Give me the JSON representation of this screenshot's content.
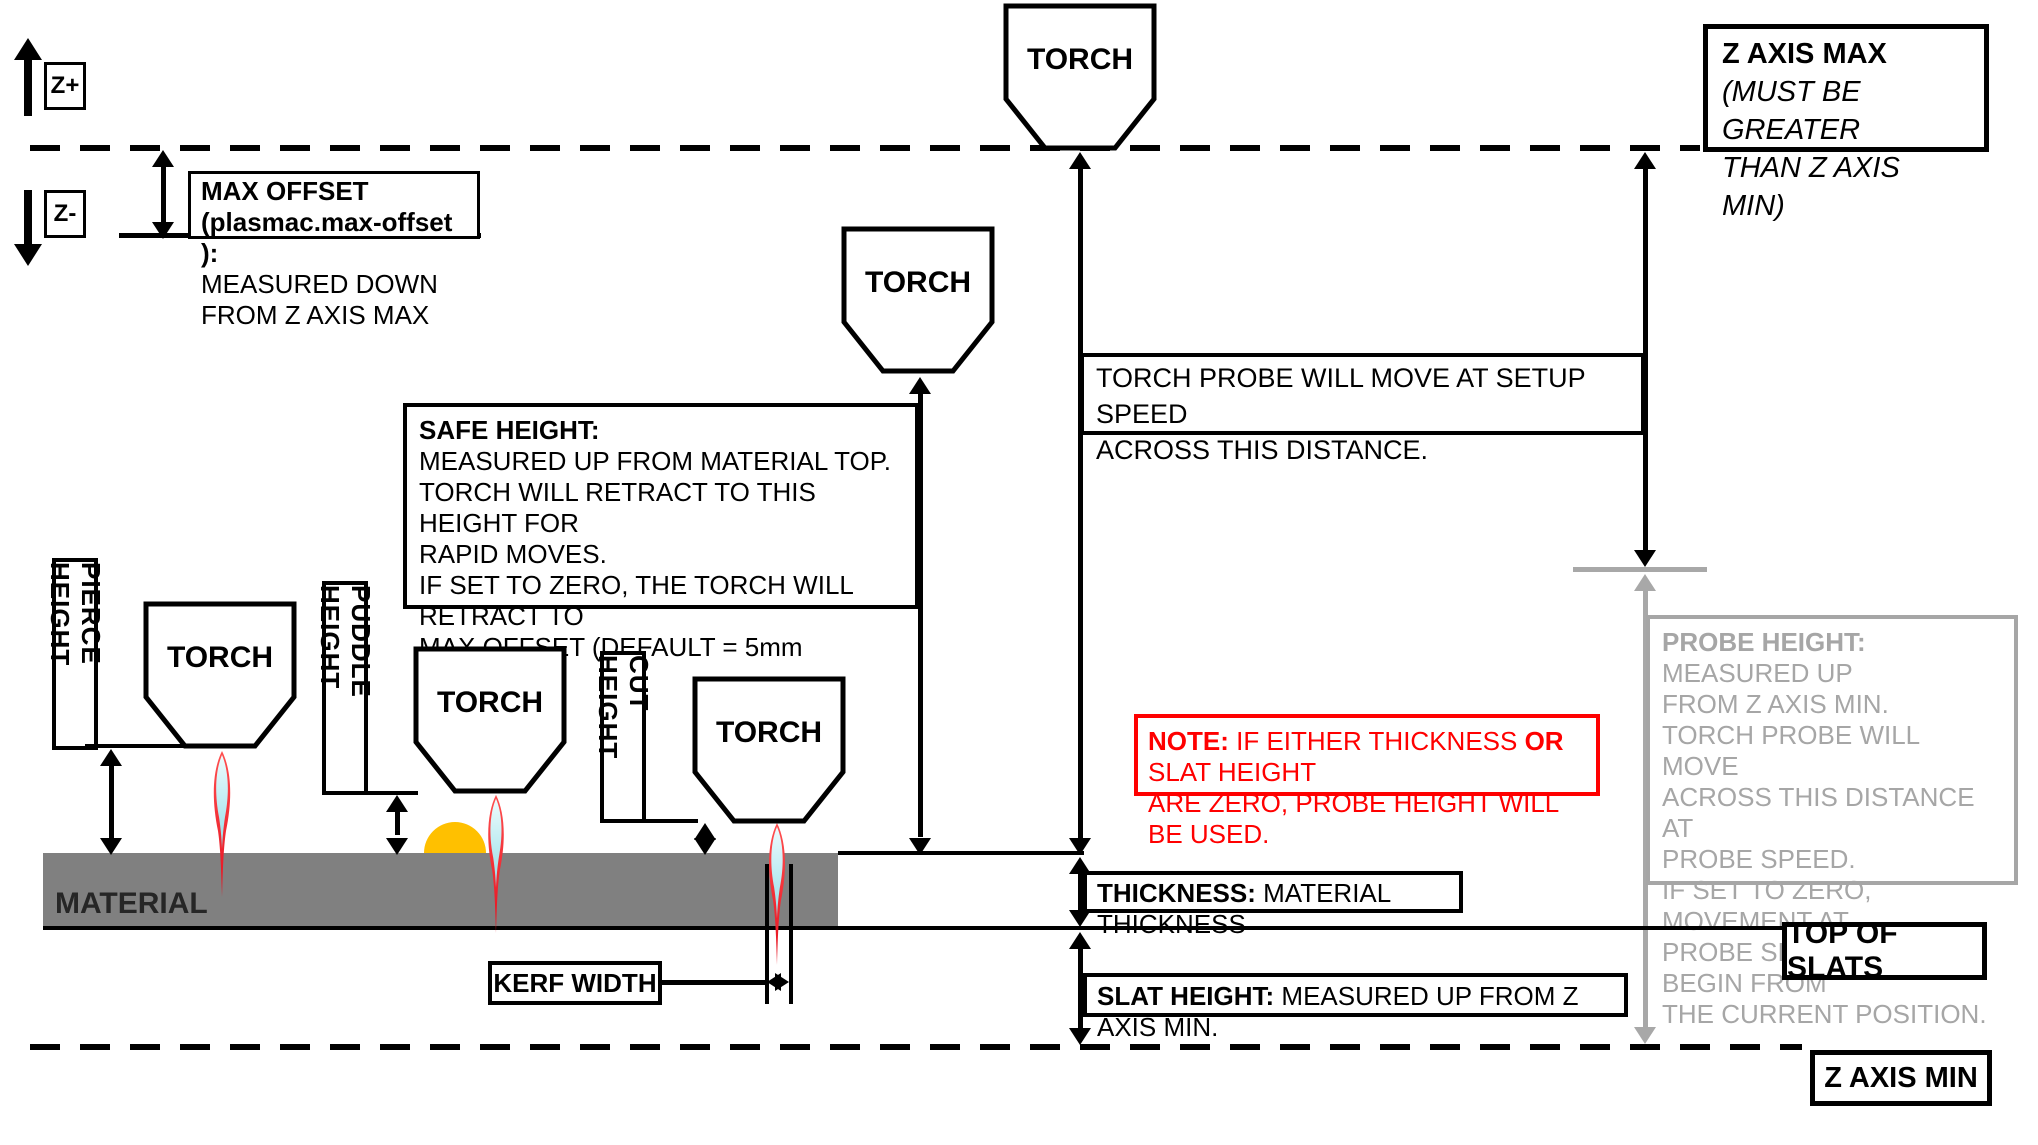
{
  "axis": {
    "z_plus": "Z+",
    "z_minus": "Z-",
    "z_axis_max_title": "Z AXIS MAX",
    "z_axis_max_line2": "(MUST BE GREATER",
    "z_axis_max_line3": "THAN Z AXIS MIN)",
    "z_axis_min": "Z AXIS MIN",
    "top_of_slats": "TOP OF SLATS"
  },
  "torch_label": "TORCH",
  "material_label": "MATERIAL",
  "height_labels": {
    "pierce": "PIERCE HEIGHT",
    "puddle": "PUDDLE HEIGHT",
    "cut": "CUT HEIGHT",
    "kerf": "KERF WIDTH"
  },
  "max_offset": {
    "title": "MAX OFFSET (plasmac.max-offset ):",
    "body": "MEASURED DOWN FROM Z AXIS MAX"
  },
  "safe_height": {
    "title": "SAFE HEIGHT:",
    "lines": [
      "MEASURED UP FROM MATERIAL TOP.",
      "TORCH WILL RETRACT TO THIS HEIGHT FOR",
      "RAPID MOVES.",
      "IF SET TO ZERO, THE TORCH WILL RETRACT TO",
      "MAX OFFSET (DEFAULT = 5mm (0.197”))."
    ]
  },
  "torch_probe": {
    "line1": "TORCH PROBE WILL MOVE AT SETUP SPEED",
    "line2": "ACROSS THIS DISTANCE."
  },
  "probe_height": {
    "title": "PROBE HEIGHT:",
    "title_rest": " MEASURED UP",
    "lines": [
      "FROM Z AXIS MIN.",
      "TORCH PROBE WILL MOVE",
      "ACROSS THIS DISTANCE AT",
      "PROBE SPEED.",
      "IF SET TO ZERO,  MOVEMENT AT",
      "PROBE SPEED WILL BEGIN FROM",
      "THE CURRENT POSITION."
    ]
  },
  "note": {
    "bold1": "NOTE:",
    "part2": "  IF EITHER THICKNESS ",
    "bold2": "OR",
    "part3": " SLAT HEIGHT",
    "line2": "ARE ZERO, PROBE HEIGHT WILL BE USED."
  },
  "thickness": {
    "title": "THICKNESS:",
    "rest": "  MATERIAL THICKNESS"
  },
  "slat_height": {
    "title": "SLAT HEIGHT:",
    "rest": "  MEASURED UP FROM Z AXIS MIN."
  },
  "colors": {
    "material_gray": "#808080",
    "probe_gray": "#a6a6a6",
    "note_red": "#ff0000",
    "puddle_orange": "#ffc000"
  }
}
